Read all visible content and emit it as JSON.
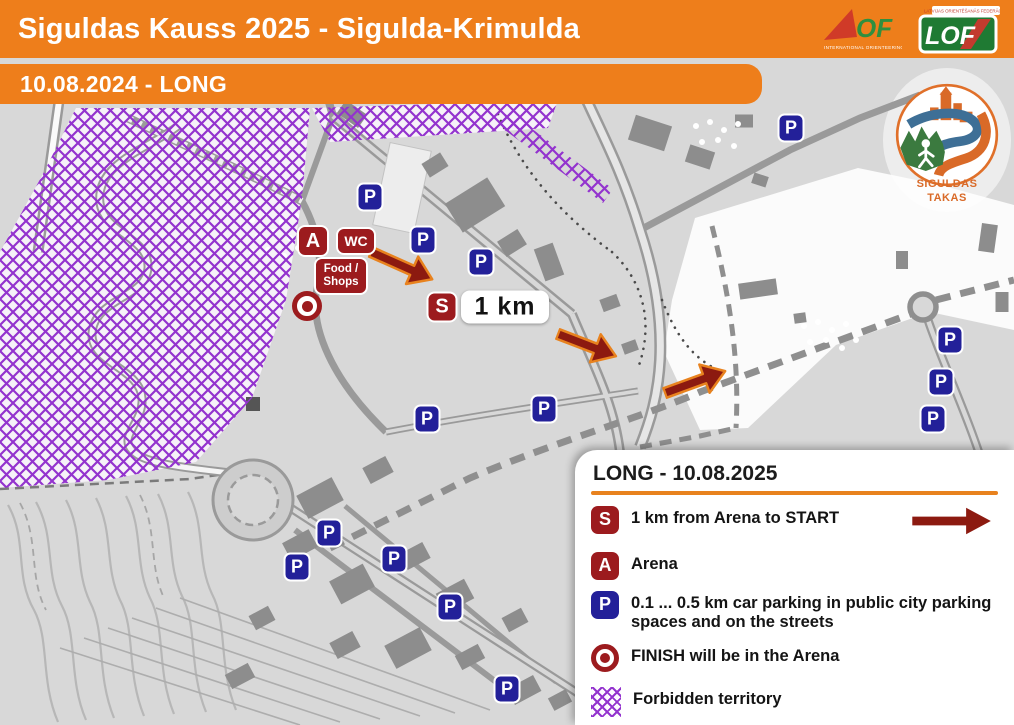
{
  "header": {
    "title": "Siguldas Kauss 2025 - Sigulda-Krimulda",
    "date_band": "10.08.2024 - LONG",
    "iof_of": "OF",
    "iof_tagline": "INTERNATIONAL ORIENTEERING FEDERATION",
    "lof_text": "LOF",
    "lof_tagline": "LATVIJAS ORIENTĒŠANĀS FEDERĀCIJA"
  },
  "badge": {
    "line1": "SIGULDAS",
    "line2": "TAKAS"
  },
  "map": {
    "markers": [
      {
        "type": "parking",
        "label": "P",
        "x": 370,
        "y": 197
      },
      {
        "type": "parking",
        "label": "P",
        "x": 423,
        "y": 240
      },
      {
        "type": "parking",
        "label": "P",
        "x": 481,
        "y": 262
      },
      {
        "type": "parking",
        "label": "P",
        "x": 791,
        "y": 128
      },
      {
        "type": "parking",
        "label": "P",
        "x": 427,
        "y": 419
      },
      {
        "type": "parking",
        "label": "P",
        "x": 544,
        "y": 409
      },
      {
        "type": "parking",
        "label": "P",
        "x": 329,
        "y": 533
      },
      {
        "type": "parking",
        "label": "P",
        "x": 297,
        "y": 567
      },
      {
        "type": "parking",
        "label": "P",
        "x": 394,
        "y": 559
      },
      {
        "type": "parking",
        "label": "P",
        "x": 450,
        "y": 607
      },
      {
        "type": "parking",
        "label": "P",
        "x": 507,
        "y": 689
      },
      {
        "type": "parking",
        "label": "P",
        "x": 950,
        "y": 340
      },
      {
        "type": "parking",
        "label": "P",
        "x": 941,
        "y": 382
      },
      {
        "type": "parking",
        "label": "P",
        "x": 933,
        "y": 419
      },
      {
        "type": "arena",
        "label": "A",
        "x": 313,
        "y": 241
      },
      {
        "type": "wc",
        "label": "WC",
        "x": 356,
        "y": 241
      },
      {
        "type": "food",
        "label_lines": [
          "Food /",
          "Shops"
        ],
        "x": 341,
        "y": 276
      },
      {
        "type": "finish",
        "x": 307,
        "y": 306
      },
      {
        "type": "start",
        "label": "S",
        "x": 442,
        "y": 307
      },
      {
        "type": "km_flag",
        "label": "1 km",
        "x": 505,
        "y": 307
      }
    ]
  },
  "legend": {
    "title": "LONG - 10.08.2025",
    "items": [
      {
        "type": "start",
        "icon_label": "S",
        "text": "1 km from Arena to START",
        "arrow": true
      },
      {
        "type": "arena",
        "icon_label": "A",
        "text": "Arena"
      },
      {
        "type": "parking",
        "icon_label": "P",
        "text": "0.1 ... 0.5 km car parking in public city parking spaces and on the streets"
      },
      {
        "type": "finish",
        "text": "FINISH will be in the Arena"
      },
      {
        "type": "forbidden",
        "text": "Forbidden territory"
      }
    ]
  },
  "colors": {
    "orange": "#EE7E1B",
    "dark_red": "#9C1B1E",
    "arrow_red": "#8C1A10",
    "arrow_outline": "#E8821E",
    "parking_blue": "#232099",
    "forbidden_purple": "#9333CE"
  }
}
